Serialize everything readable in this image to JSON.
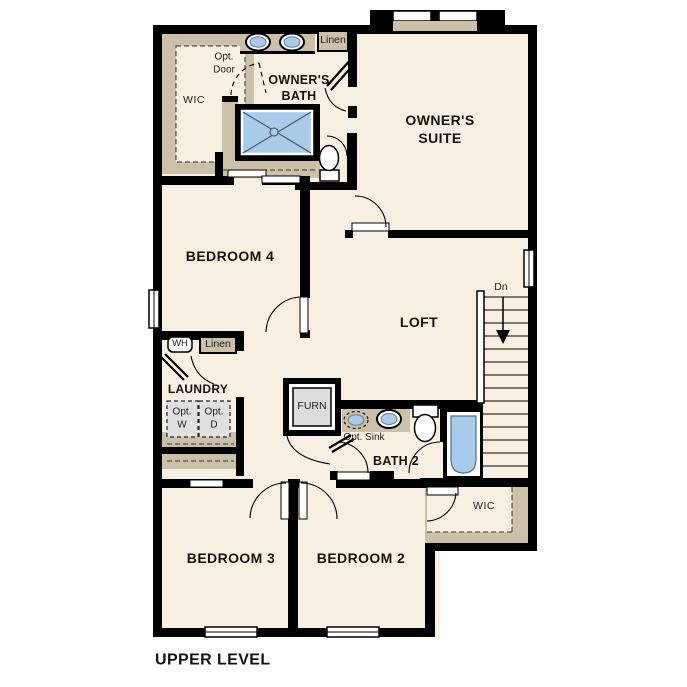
{
  "plan": {
    "level_title": "UPPER LEVEL",
    "colors": {
      "floor": "#f7efe2",
      "wall": "#000000",
      "tan": "#cbc0a8",
      "fixture_blue": "#a8cbe9",
      "appliance_gray": "#e0e0e0"
    },
    "rooms": {
      "owners_suite": "OWNER'S\nSUITE",
      "owners_bath": "OWNER'S\nBATH",
      "wic_owners": "WIC",
      "bedroom4": "BEDROOM 4",
      "loft": "LOFT",
      "laundry": "LAUNDRY",
      "bath2": "BATH 2",
      "bedroom3": "BEDROOM 3",
      "bedroom2": "BEDROOM 2",
      "wic_bedroom2": "WIC"
    },
    "annotations": {
      "opt_door": "Opt.\nDoor",
      "linen_bath": "Linen",
      "linen_hall": "Linen",
      "water_heater": "WH",
      "opt_washer": "Opt.\nW",
      "opt_dryer": "Opt.\nD",
      "furnace": "FURN",
      "opt_sink": "Opt. Sink",
      "stairs_down": "Dn"
    }
  }
}
